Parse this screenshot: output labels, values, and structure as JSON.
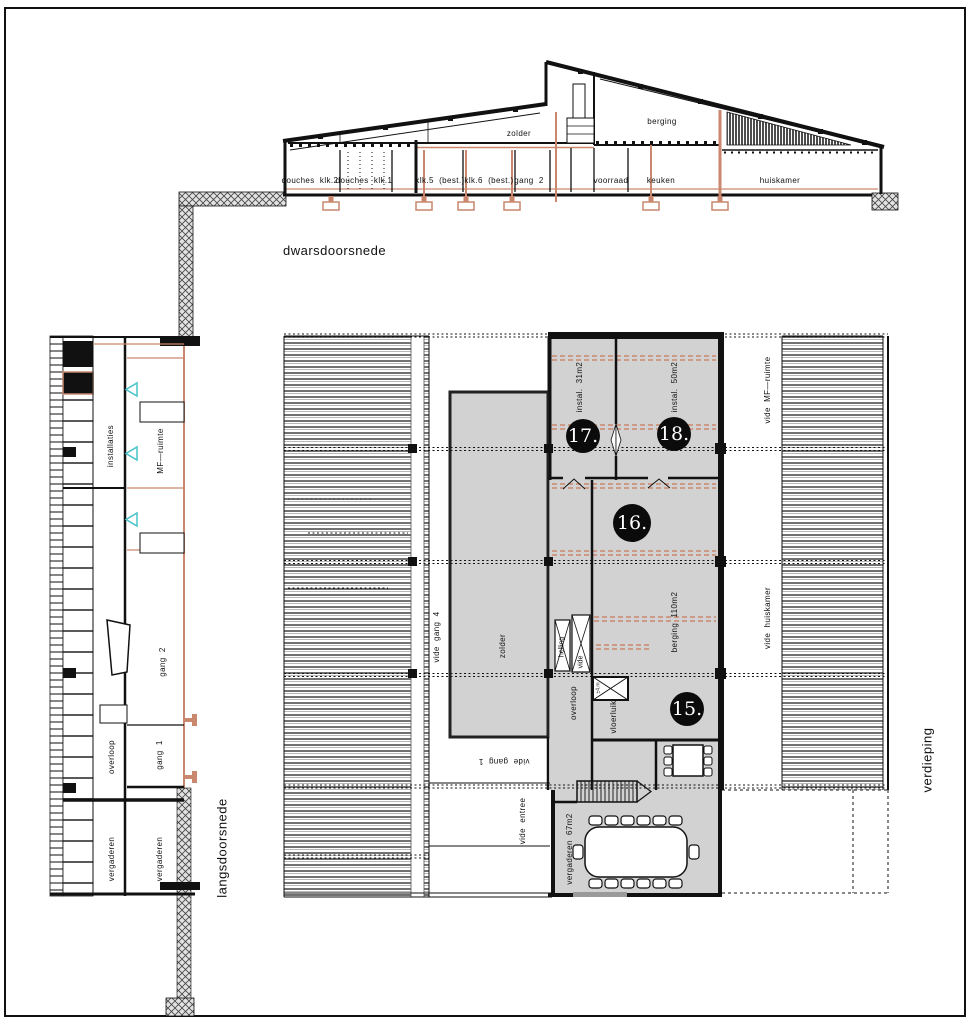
{
  "colors": {
    "salmon": "#c9876d",
    "cyan": "#4ac3c7",
    "room_gray": "#d2d2d2",
    "line": "#111111"
  },
  "cross_section": {
    "title": "dwarsdoorsnede",
    "attic": {
      "zolder": "zolder",
      "berging": "berging"
    },
    "rooms": {
      "douches2": "douches  klk.2",
      "douches1": "douches  klk.1",
      "klk5": "klk.5  (best.)",
      "klk6": "klk.6  (best.)",
      "gang2": "gang  2",
      "voorraad": "voorraad",
      "keuken": "keuken",
      "huiskamer": "huiskamer"
    }
  },
  "long_section": {
    "title": "langsdoorsnede",
    "labels": {
      "installaties": "installaties",
      "mf_ruimte": "MF—ruimte",
      "gang2": "gang  2",
      "overloop": "overloop",
      "gang1": "gang  1",
      "vergaderen_links": "vergaderen",
      "vergaderen_rechts": "vergaderen"
    }
  },
  "plan": {
    "title": "verdieping",
    "labels": {
      "instal31": "instal.  31m2",
      "instal50": "instal.  50m2",
      "vide_mf": "vide  MF—ruimte",
      "vide_huiskamer": "vide  huiskamer",
      "vide_gang4": "vide  gang  4",
      "zolder": "zolder",
      "berging110": "berging  110m2",
      "helling": "helling",
      "vide": "vide",
      "overloop": "overloop",
      "vloerluik": "vloerluik",
      "luik_dim": "±4.m",
      "vide_gang1": "vide  gang  1",
      "vide_entree": "vide  entree",
      "vergaderen67": "vergaderen  67m2"
    },
    "markers": {
      "m15": "15.",
      "m16": "16.",
      "m17": "17.",
      "m18": "18."
    }
  }
}
